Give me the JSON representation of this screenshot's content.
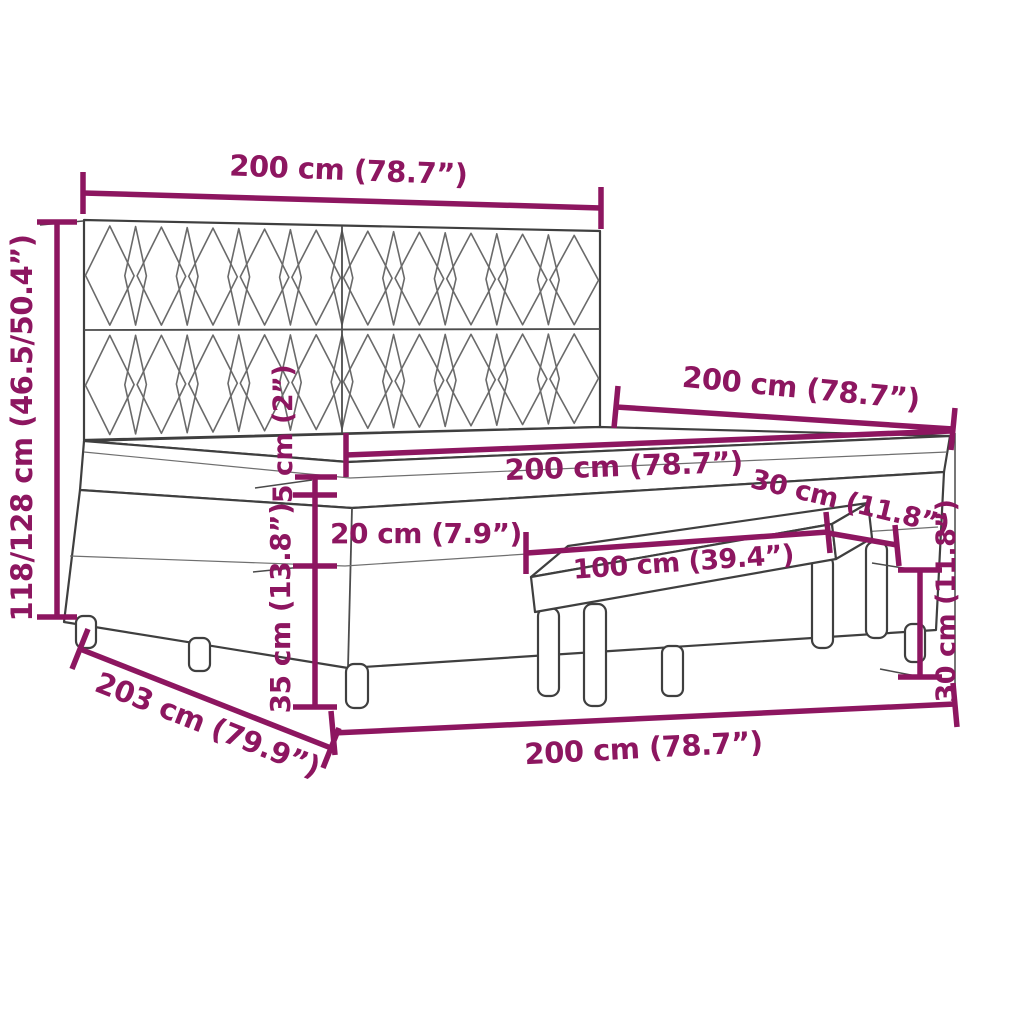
{
  "colors": {
    "dimension": "#8d1660",
    "outline": "#3f3f3f",
    "background": "#ffffff"
  },
  "labels": {
    "headboard_width": "200 cm (78.7”)",
    "overall_height": "118/128 cm (46.5/50.4”)",
    "bed_length": "200 cm (78.7”)",
    "mattress_width": "200 cm (78.7”)",
    "bench_depth": "30 cm (11.8”)",
    "topper_height": "5 cm (2”)",
    "mattress_height": "20 cm (7.9”)",
    "base_height": "35 cm (13.8”)",
    "bench_width": "100 cm (39.4”)",
    "bench_height": "30 cm (11.8”)",
    "total_length": "203 cm (79.9”)",
    "bed_width": "200 cm (78.7”)"
  }
}
